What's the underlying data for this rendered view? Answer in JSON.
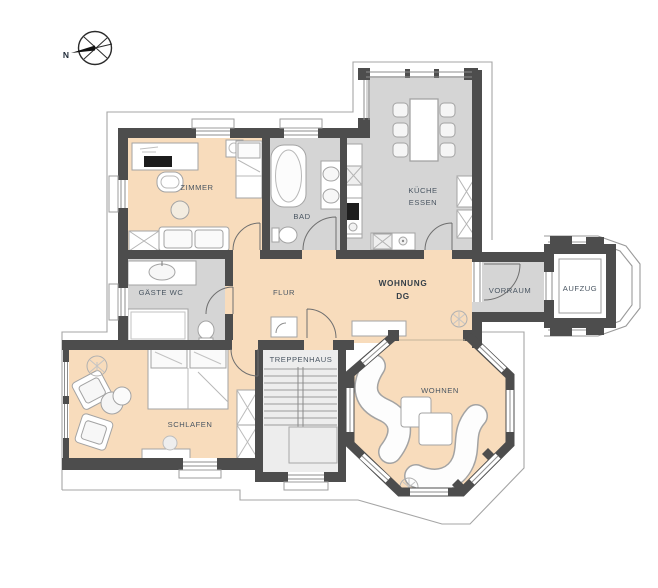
{
  "title": "Wohnung DG floor plan",
  "colors": {
    "floor_warm": "#f8dcbc",
    "floor_gray": "#d5d5d5",
    "floor_stair": "#ededed",
    "wall": "#4d4d4d",
    "eaves_outline": "#a5a5a5",
    "furniture_stroke": "#a3a3a3",
    "label": "#4a5662",
    "label_strong": "#343f49"
  },
  "labels": {
    "north": "N",
    "zimmer": "ZIMMER",
    "bad": "BAD",
    "kueche_line1": "KÜCHE",
    "kueche_line2": "ESSEN",
    "gaeste_wc": "GÄSTE WC",
    "flur": "FLUR",
    "wohnung_line1": "WOHNUNG",
    "wohnung_line2": "DG",
    "vorraum": "VORRAUM",
    "aufzug": "AUFZUG",
    "treppenhaus": "TREPPENHAUS",
    "schlafen": "SCHLAFEN",
    "wohnen": "WOHNEN"
  }
}
